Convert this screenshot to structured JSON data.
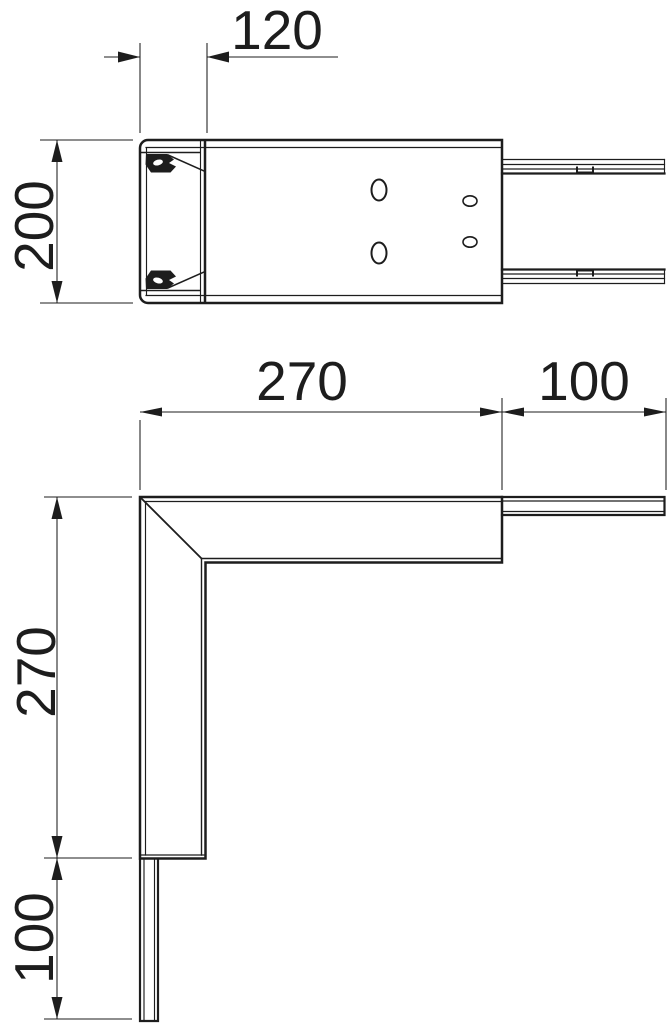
{
  "drawing": {
    "background": "#ffffff",
    "line_color": "#1d1d1d",
    "top_view": {
      "dim_offset": "120",
      "dim_height": "200"
    },
    "corner_view": {
      "dim_leg_horizontal": "270",
      "dim_duct_horizontal": "100",
      "dim_leg_vertical": "270",
      "dim_duct_vertical": "100"
    }
  }
}
